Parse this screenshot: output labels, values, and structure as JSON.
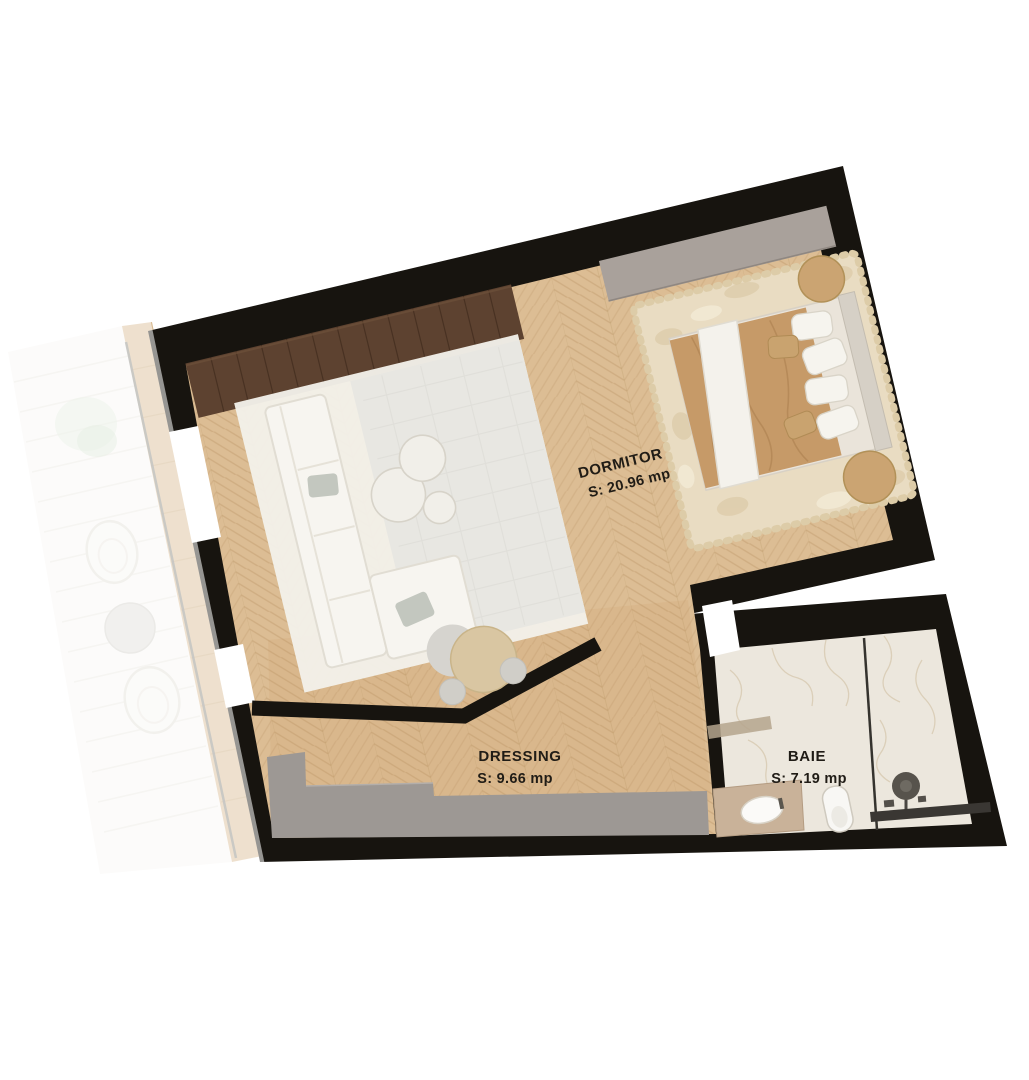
{
  "plan": {
    "rooms": [
      {
        "name": "DORMITOR",
        "area": "S: 20.96 mp"
      },
      {
        "name": "DRESSING",
        "area": "S: 9.66 mp"
      },
      {
        "name": "BAIE",
        "area": "S: 7.19 mp"
      }
    ],
    "colors": {
      "background": "#ffffff",
      "wall": "#17140f",
      "wood_floor": "#dcbd94",
      "wood_plank_line": "#c4a072",
      "bath_floor": "#ece7dd",
      "furniture_gray": "#a9a19b",
      "dressing_wardrobe_gray": "#9d9894",
      "wardrobe_walnut": "#5d4230",
      "blanket_tan": "#c69a68",
      "bed_rug_cream": "#e9dcc2",
      "sitting_rug_white": "#f3f0e9",
      "terrace_white": "#f8f7f4",
      "label_text": "#201c16"
    }
  }
}
